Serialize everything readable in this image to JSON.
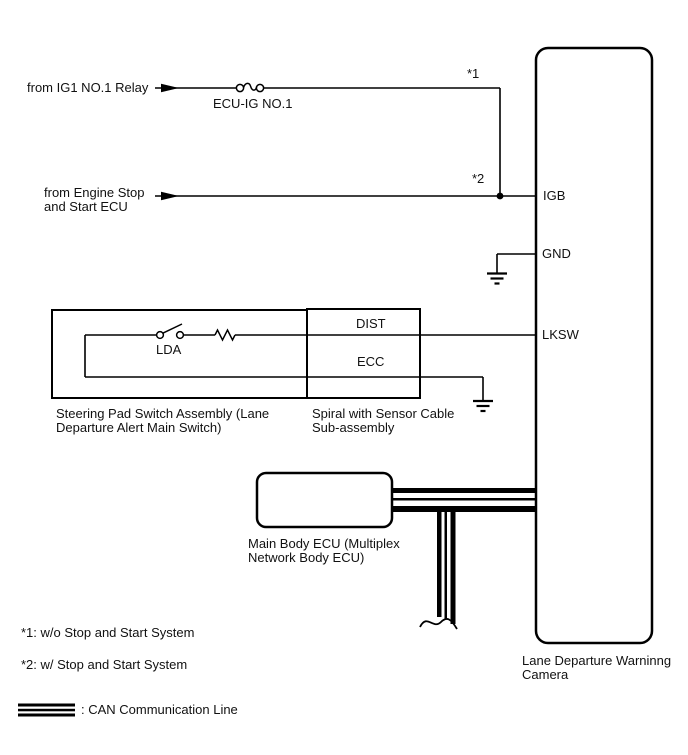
{
  "colors": {
    "line": "#000000",
    "text": "#111111",
    "background": "#ffffff"
  },
  "inputs": {
    "ig1": {
      "source": "from IG1 NO.1 Relay",
      "fuse": "ECU-IG NO.1",
      "ref": "*1"
    },
    "stop_start": {
      "source": "from Engine Stop\nand Start ECU",
      "ref": "*2"
    }
  },
  "camera": {
    "label": "Lane Departure Warninng\nCamera",
    "pins": {
      "igb": "IGB",
      "gnd": "GND",
      "lksw": "LKSW"
    }
  },
  "switch_assembly": {
    "label": "Steering Pad Switch Assembly (Lane\nDeparture Alert Main Switch)",
    "switch": "LDA"
  },
  "spiral_cable": {
    "label": "Spiral with Sensor Cable\nSub-assembly",
    "pins": {
      "dist": "DIST",
      "ecc": "ECC"
    }
  },
  "main_body_ecu": {
    "label": "Main Body ECU (Multiplex\nNetwork Body ECU)"
  },
  "notes": {
    "note1": "*1: w/o Stop and Start System",
    "note2": "*2: w/ Stop and Start System"
  },
  "legend": {
    "can": ": CAN Communication Line"
  }
}
